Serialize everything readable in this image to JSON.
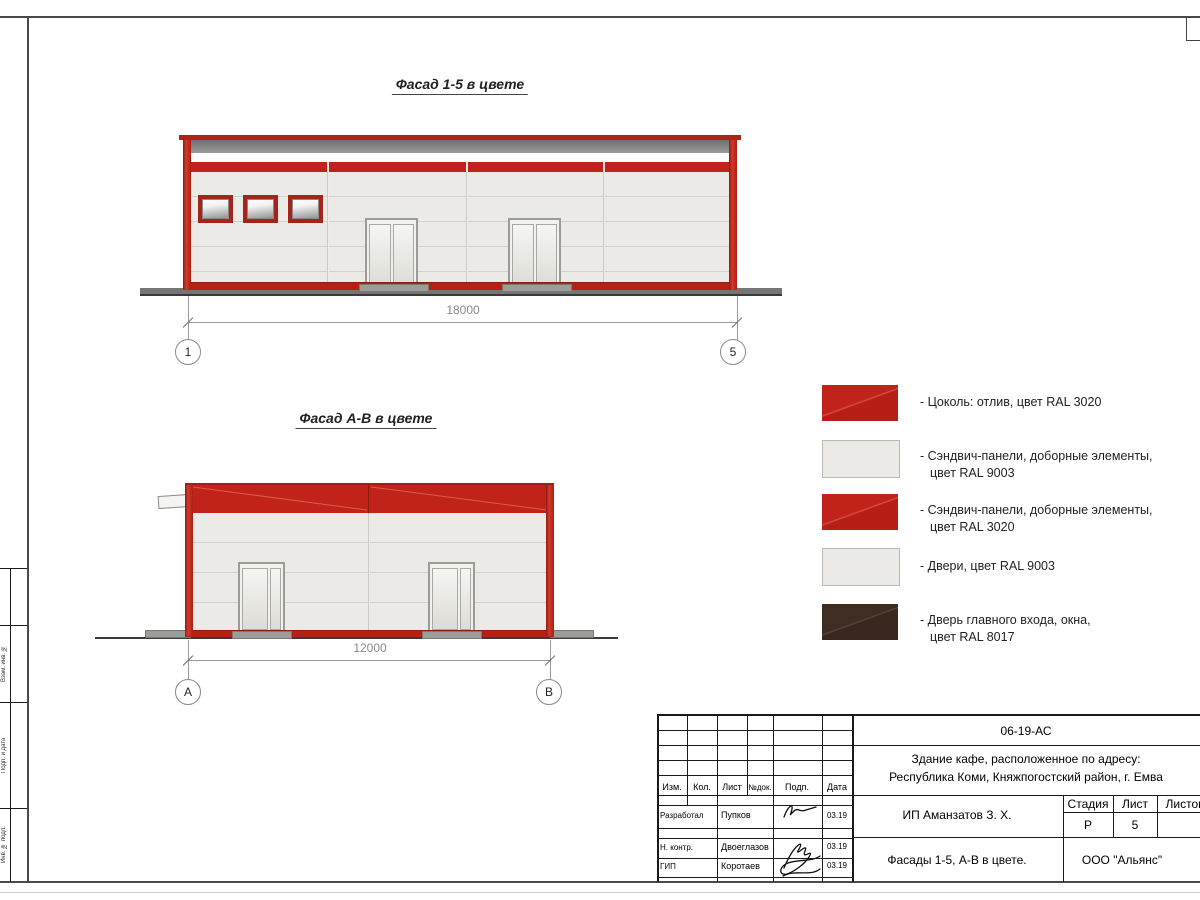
{
  "facade_top": {
    "title": "Фасад 1-5 в цвете",
    "dimension": "18000",
    "marker_left": "1",
    "marker_right": "5"
  },
  "facade_side": {
    "title": "Фасад А-В в цвете",
    "dimension": "12000",
    "marker_left": "А",
    "marker_right": "В"
  },
  "colors": {
    "ral3020_red": "#c1221a",
    "ral9003_white": "#eceae6",
    "ral8017_brown": "#3f2d24",
    "parapet_gray": "#8c8c8c"
  },
  "legend": {
    "items": [
      {
        "swatch": "red-ral3020",
        "line1": "- Цоколь: отлив, цвет RAL 3020",
        "line2": ""
      },
      {
        "swatch": "light-ral9003",
        "line1": "- Сэндвич-панели, доборные элементы,",
        "line2": "цвет RAL 9003"
      },
      {
        "swatch": "red-ral3020",
        "line1": "- Сэндвич-панели, доборные элементы,",
        "line2": "цвет RAL 3020"
      },
      {
        "swatch": "light-ral9003",
        "line1": "- Двери, цвет RAL 9003",
        "line2": ""
      },
      {
        "swatch": "brown-ral8017",
        "line1": "- Дверь главного входа, окна,",
        "line2": "цвет RAL 8017"
      }
    ]
  },
  "title_block": {
    "doc_number": "06-19-АС",
    "address_line1": "Здание кафе, расположенное по адресу:",
    "address_line2": "Республика Коми, Княжпогостский район, г. Емва",
    "client": "ИП Аманзатов З. Х.",
    "sheet_title": "Фасады 1-5, А-В в цвете.",
    "company": "ООО \"Альянс\"",
    "headers": {
      "izm": "Изм.",
      "kol": "Кол.",
      "list": "Лист",
      "ndok": "№док.",
      "podp": "Подп.",
      "data": "Дата"
    },
    "stage_header": "Стадия",
    "sheet_header": "Лист",
    "sheets_header": "Листов",
    "stage_value": "Р",
    "sheet_value": "5",
    "rows": [
      {
        "role": "Разработал",
        "name": "Пупков",
        "date": "03.19"
      },
      {
        "role": "Н. контр.",
        "name": "Двоеглазов",
        "date": "03.19"
      },
      {
        "role": "ГИП",
        "name": "Коротаев",
        "date": "03.19"
      }
    ]
  },
  "margin_labels": [
    "Взам. инв. №",
    "Подп. и дата",
    "Инв. № подл."
  ]
}
